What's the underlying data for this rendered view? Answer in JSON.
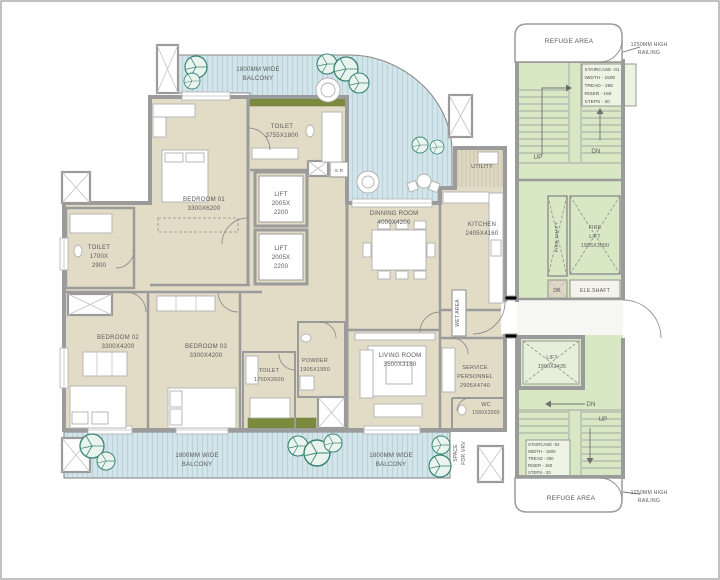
{
  "colors": {
    "room_fill": "#e2dcc7",
    "balcony_fill": "#d3e5eb",
    "balcony_stripe": "#b9d3db",
    "core_fill": "#d8e8c5",
    "planter_green": "#7c8a3e",
    "wall_gray": "#9b9b9b",
    "tree_green": "#3a8474",
    "label_gray": "#5a5a5a"
  },
  "apartment": {
    "bedroom01": {
      "name": "BEDROOM 01",
      "dims": "3300X6200"
    },
    "toilet_top": {
      "name": "TOILET",
      "dims": "3755X1800"
    },
    "lift_a": {
      "name": "LIFT",
      "dim1": "2005X",
      "dim2": "2200"
    },
    "lift_b": {
      "name": "LIFT",
      "dim1": "2005X",
      "dim2": "2200"
    },
    "store": {
      "name": "S.R"
    },
    "toilet_left": {
      "name": "TOILET",
      "dim1": "1700X",
      "dim2": "2900"
    },
    "bedroom02": {
      "name": "BEDROOM 02",
      "dims": "3300X4200"
    },
    "bedroom03": {
      "name": "BEDROOM 03",
      "dims": "3300X4200"
    },
    "toilet_mid": {
      "name": "TOILET",
      "dims": "1700X2600"
    },
    "powder": {
      "name": "POWDER",
      "dims": "1905X1950"
    },
    "living": {
      "name": "LIVING ROOM",
      "dims": "3500X3180"
    },
    "dining": {
      "name": "DINNING ROOM",
      "dims": "4000X4200"
    },
    "kitchen": {
      "name": "KITCHEN",
      "dims": "2405X4160"
    },
    "utility": {
      "name": "UTILITY"
    },
    "wet_area": {
      "name": "WET AREA"
    },
    "service": {
      "name1": "SERVICE",
      "name2": "PERSONNEL",
      "dims": "2905X4740"
    },
    "wc": {
      "name": "WC",
      "dims": "1560X2000"
    },
    "vrv": {
      "name1": "SPACE",
      "name2": "FOR VRV"
    }
  },
  "balconies": {
    "top": {
      "line1": "1800MM WIDE",
      "line2": "BALCONY"
    },
    "bottom_left": {
      "line1": "1800MM WIDE",
      "line2": "BALCONY"
    },
    "bottom_right": {
      "line1": "1800MM WIDE",
      "line2": "BALCONY"
    }
  },
  "core": {
    "refuge_top": "REFUGE AREA",
    "refuge_bottom": "REFUGE AREA",
    "railing_top": {
      "line1": "1250MM HIGH",
      "line2": "RAILING"
    },
    "railing_bottom": {
      "line1": "1250MM HIGH",
      "line2": "RAILING"
    },
    "staircase1": {
      "line1": "STAIRCASE -01",
      "line2": "WIDTH - 1500",
      "line3": "TREAD - 250",
      "line4": "RISER - 160",
      "line5": "STEPS - 20"
    },
    "staircase2": {
      "line1": "STAIRCASE -02",
      "line2": "WIDTH - 1500",
      "line3": "TREAD - 250",
      "line4": "RISER - 160",
      "line5": "STEPS - 20"
    },
    "stair1_up": "UP",
    "stair1_dn": "DN",
    "stair2_dn": "DN",
    "stair2_up": "UP",
    "fire_shaft": "FIRE SHAFT",
    "fire_lift": {
      "name1": "FIRE",
      "name2": "LIFT",
      "dims": "1985X3000"
    },
    "db": "DB",
    "ele_shaft": "ELE.SHAFT",
    "lift": {
      "name": "LIFT",
      "dims": "1900X2435"
    }
  }
}
